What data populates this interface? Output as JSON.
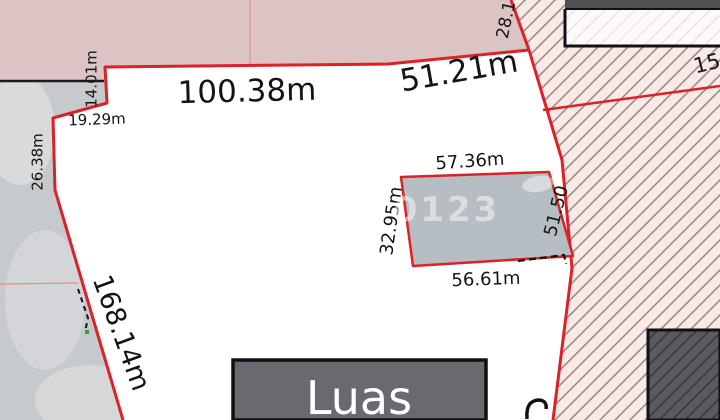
{
  "map": {
    "type": "cadastral-parcel-plan",
    "labels": {
      "top_edge": "100.38m",
      "top_right_edge": "51.21m",
      "corner_edge": "28.1",
      "neighbor": "15",
      "step_edge": "14.01m",
      "notch_edge": "19.29m",
      "left_upper_edge": "26.38m",
      "left_long_edge": "168.14m",
      "inner_top": "57.36m",
      "inner_left": "32.95m",
      "inner_right": "51.50",
      "inner_bottom": "56.61m",
      "watermark": "0123",
      "area_box": "Luas"
    },
    "colors": {
      "boundary_red": "#dd2127",
      "thin_red_line": "#e98b8b",
      "zone_pink": "#dcc4c4",
      "hatch_background": "#f9e9e7",
      "hatch_line": "#9d8b87",
      "ground_gray": "#c7cacd",
      "inner_parcel_fill": "#b6bdc3",
      "building_dark": "#5a5a5f",
      "area_box_fill": "#696970",
      "label_text": "#141414"
    }
  }
}
